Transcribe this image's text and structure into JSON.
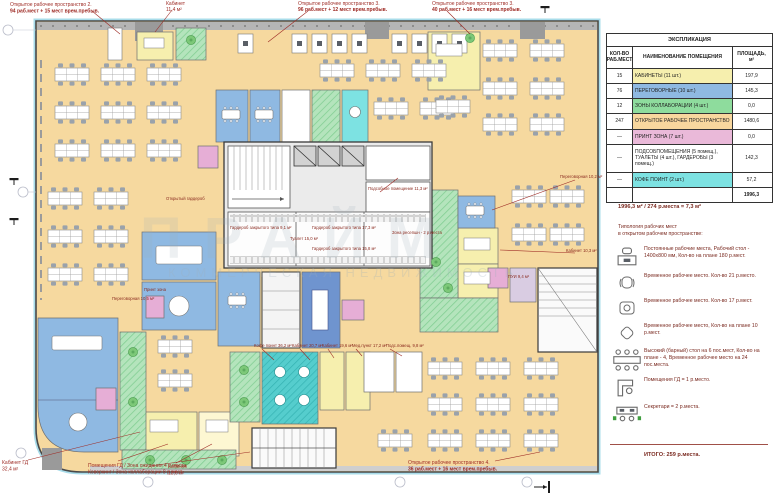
{
  "legend": {
    "title": "ЭКСПЛИКАЦИЯ",
    "col_count": "КОЛ-ВО РАБ.МЕСТ",
    "col_name": "НАИМЕНОВАНИЕ ПОМЕЩЕНИЯ",
    "col_area": "ПЛОЩАДЬ, м²",
    "rows": [
      {
        "count": "15",
        "name": "КАБИНЕТЫ (11 шт.)",
        "area": "197,9",
        "color": "#f6efae"
      },
      {
        "count": "76",
        "name": "ПЕРЕГОВОРНЫЕ (10 шт.)",
        "area": "145,3",
        "color": "#8fb9e2"
      },
      {
        "count": "12",
        "name": "ЗОНЫ КОЛЛАБОРАЦИИ (4 шт.)",
        "area": "0,0",
        "color": "#8edc9d"
      },
      {
        "count": "247",
        "name": "ОТКРЫТОЕ РАБОЧЕЕ ПРОСТРАНСТВО",
        "area": "1480,6",
        "color": "#f8d79e"
      },
      {
        "count": "—",
        "name": "ПРИНТ ЗОНА (7 шт.)",
        "area": "0,0",
        "color": "#eab9d9"
      },
      {
        "count": "—",
        "name": "ПОДСОБПОМЕЩЕНИЯ (5 помещ.), ТУАЛЕТЫ (4 шт.), ГАРДЕРОБЫ (3 помещ.)",
        "area": "142,3",
        "color": "#ffffff"
      },
      {
        "count": "—",
        "name": "КОФЕ ПОИНТ (2 шт.)",
        "area": "57,2",
        "color": "#7de2e2"
      }
    ],
    "total_area": "1996,3"
  },
  "summary": {
    "ratio_line": "1996,3 м² / 274 р.места = 7,3 м²"
  },
  "typology": {
    "heading_line1": "Типология рабочих мест",
    "heading_line2": "в открытом рабочем пространстве:",
    "items": [
      {
        "icon": "desk-workstation",
        "text": "Постоянные рабочие места, Рабочий стол - 1400x800 мм, Кол-во на плане 180 р.мест."
      },
      {
        "icon": "office-chair",
        "text": "Временное рабочее место. Кол-во 21 р.место."
      },
      {
        "icon": "lounge-chair",
        "text": "Временное рабочее место. Кол-во 17 р.мест."
      },
      {
        "icon": "pouf",
        "text": "Временное рабочее место, Кол-во на плане 10 р.мест."
      },
      {
        "icon": "bar-table-stools",
        "text": "Высокий (барный) стол на 6 пос.мест, Кол-во на плане - 4, Временное рабочее место на 24 пос.места."
      },
      {
        "icon": "director-desk",
        "text": "Помещения ГД = 1 р.место."
      },
      {
        "icon": "secretary-desks",
        "text": "Секретари = 2 р.места."
      }
    ],
    "total_line": "ИТОГО: 259 р.места."
  },
  "annotations": [
    {
      "line1": "Открытое рабочее пространство 2.",
      "line2": "94 раб.мест + 15 мест врем.пребыв."
    },
    {
      "line1": "Кабинет",
      "line2": "11,4 м²"
    },
    {
      "line1": "Открытое рабочее пространство 3.",
      "line2": "96 раб.мест + 12 мест врем.пребыв."
    },
    {
      "line1": "Открытое рабочее пространство 3.",
      "line2": "40 раб.мест + 16 мест врем.пребыв."
    },
    {
      "line1": "Кабинет ГД",
      "line2": "32,4 м²"
    },
    {
      "line1": "Помещения ГД / Зона ожидания 4 р.места,",
      "line2": "Коворкинг / Зона коллаборации 8 р.мест."
    },
    {
      "line1": "Кабинет",
      "line2": "13,6 м²"
    },
    {
      "line1": "Открытое рабочее пространство 4.",
      "line2": "36 раб.мест + 16 мест врем.пребыв."
    }
  ],
  "room_labels": [
    "Гардероб закрытого типа 9,1 м²",
    "Туалет 15,0 м²",
    "Гардероб закрытого типа 17,3 м²",
    "Гардероб закрытого типа 15,8 м²",
    "Подсобное помещение 11,3 м²",
    "Зона ресепшн - 2 р.места",
    "Открытый гардероб",
    "Принт зона",
    "Переговорная 10,5 м²",
    "Кофе поинт 36,2 м²",
    "Кабинет 20,7 м²",
    "Кабинет 19,6 м²",
    "Мед.пункт 17,2 м²",
    "Подс.помещ. 9,8 м²",
    "ПУИ 9,4 м²",
    "Переговорная 10,2 м²",
    "Кабинет 10,3 м²"
  ],
  "watermark": {
    "line1": "ПРАЙМ",
    "line2": "КОММЕРЧЕСКАЯ НЕДВИЖИМОСТЬ"
  },
  "colors": {
    "open_space": "#f6d99f",
    "cabinet": "#f6efae",
    "meeting": "#8fb9e2",
    "meeting_dark": "#6f94cf",
    "collaboration": "#8edc9d",
    "print_zone": "#e6aed6",
    "coffee_point": "#49c9c9",
    "annotation_red": "#9e2b25",
    "glass": "#a8dcea",
    "core_gray": "#ebebeb"
  }
}
